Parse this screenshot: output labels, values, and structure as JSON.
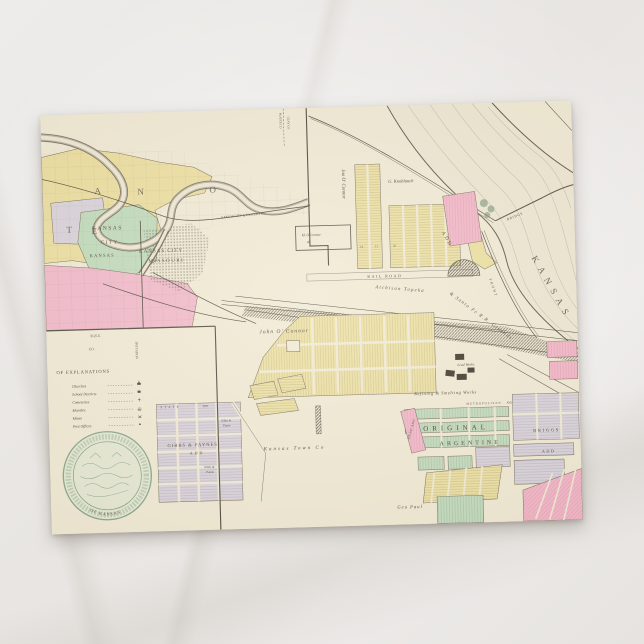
{
  "county_map": {
    "spread_letters": [
      "A",
      "N",
      "O",
      "T",
      "E"
    ],
    "city_ks": [
      "KANSAS",
      "CITY",
      "KANSAS"
    ],
    "city_mo": [
      "KANSAS CITY",
      "MISSOURI"
    ],
    "platte_co": "PLATTE CO",
    "clay_co": "CLAY CO",
    "eastern_ry": "KANSAS CITY & EASTERN RY",
    "range": "R.25 E",
    "co": "CO.",
    "state_line": "STATE LINE",
    "legend": {
      "title": "OF EXPLANATIONS",
      "items": [
        "Churches",
        "School Districts",
        "Cemeteries",
        "Marshes",
        "Mines",
        "Post Offices"
      ]
    },
    "seal_text": "OF KANSAS"
  },
  "city_map": {
    "owners": {
      "jno_oconnor": "Jno O' Connor",
      "john_oconnor": "John O' Connor",
      "knoblauch": "G. Knoblauch",
      "m_oconnor": "M. O'Connor",
      "m_oconnor_acres": "40",
      "kansas_town_co": "Kansas Town Co",
      "geo_paul": "Geo Paul"
    },
    "streets": {
      "rail_road": "RAIL ROAD",
      "front": "FRONT",
      "state": "STATE",
      "ave": "AVE",
      "metropolitan": "METROPOLITAN",
      "metropolitan_ave": "AVE"
    },
    "railroad": {
      "atsf_line1": "Atchison Topeka",
      "atsf_line2": "& Santa Fe R.R. Grounds"
    },
    "river_name": "KANSAS",
    "bridge": "BRIDGE",
    "industry": {
      "lead_works": "Lead Works",
      "smelting_works": "Refining & Smelting Works"
    },
    "additions": {
      "add": "ADD",
      "gibbs_line1": "GIBBS & PAYNES",
      "gibbs_line2": "ADD",
      "gibbs_small_line1": "Gibbs &",
      "gibbs_small_line2": "Payne",
      "original": "ORIGINAL",
      "argentine": "ARGENTINE",
      "briggs_line1": "BRIGGS",
      "briggs_line2": "ADD",
      "mead": "MEAD ADD"
    },
    "block_numbers": [
      "14",
      "11",
      "32"
    ]
  }
}
